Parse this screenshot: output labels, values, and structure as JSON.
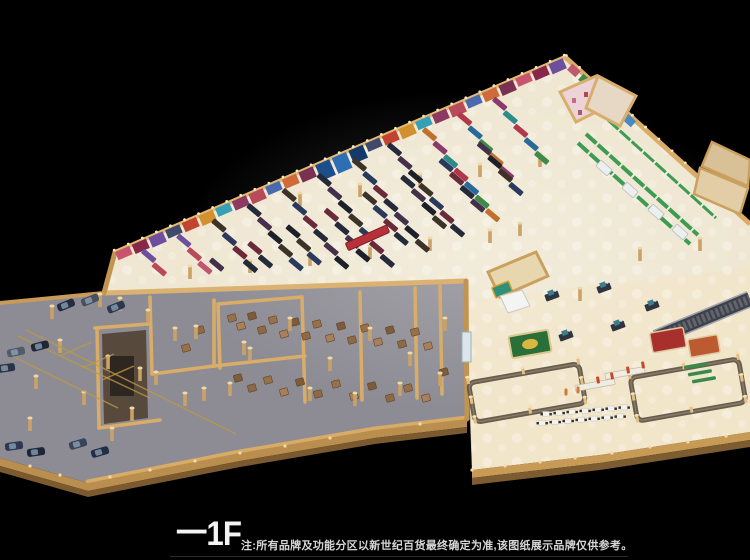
{
  "canvas": {
    "width": 750,
    "height": 560,
    "background": "#000000"
  },
  "caption": {
    "floor_label": "一1F",
    "note": "注:所有品牌及功能分区以新世纪百货最终确定为准,该图纸展示品牌仅供参考。"
  },
  "palette": {
    "floor_cream": "#efe7d2",
    "floor_warm": "#f2e3c2",
    "floor_gray": "#8d8c94",
    "wall_tan": "#d9ad68",
    "wall_light": "#e8c687",
    "wall_dark": "#7c5c30",
    "shelf_dark": "#252a3a",
    "shelf_green": "#3e9b52",
    "escalator_gray": "#3f414a",
    "box_brown": "#97714a",
    "accent_red": "#b8303a",
    "banner_blue": "#2e6fb4",
    "cap_light": "#f7e9c4"
  }
}
